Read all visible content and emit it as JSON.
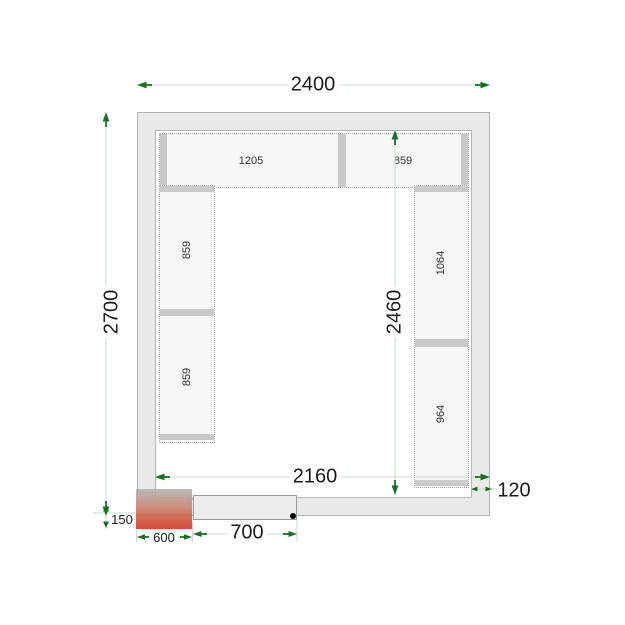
{
  "dimensions": {
    "outer_width": "2400",
    "outer_height": "2700",
    "inner_width": "2160",
    "inner_height": "2460",
    "wall_thickness": "120",
    "unit_protrusion": "150",
    "unit_width": "600",
    "door_width": "700"
  },
  "shelving": {
    "top_row": [
      {
        "length": "1205"
      },
      {
        "length": "859"
      }
    ],
    "left_column": [
      {
        "length": "859"
      },
      {
        "length": "859"
      }
    ],
    "right_column": [
      {
        "length": "1064"
      },
      {
        "length": "964"
      }
    ]
  },
  "colors": {
    "dimension_arrow": "#1b6e2a",
    "dimension_line": "#ccd8cc",
    "wall_fill": "#e9e9e9",
    "wall_border": "#b2b2b2",
    "shelf_fill": "#f6f6f6",
    "shelf_divider": "#c9c9c9",
    "unit_top": "#b3b3b3",
    "unit_bottom": "#cc3a24",
    "door_fill": "#ececec"
  }
}
